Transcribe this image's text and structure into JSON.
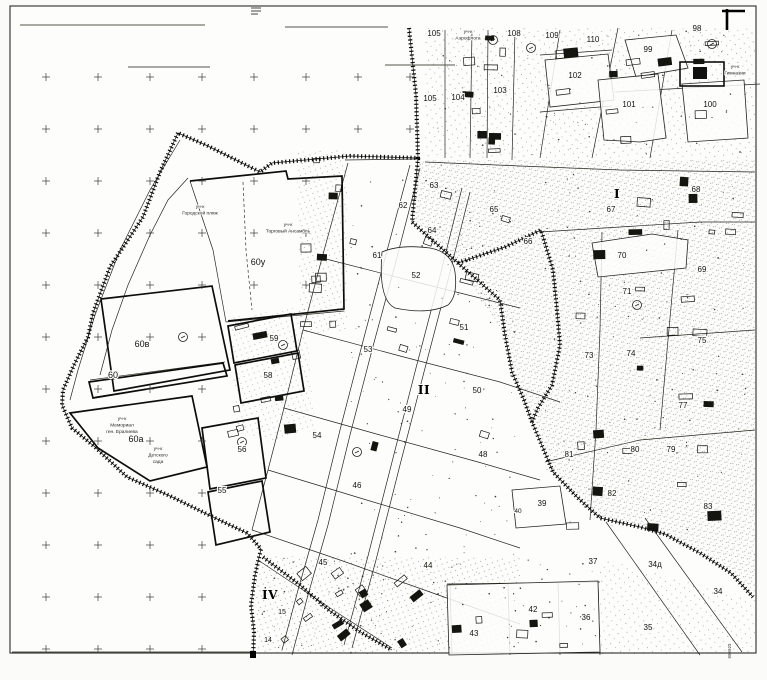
{
  "map": {
    "parcel_labels": [
      {
        "text": "105",
        "x": 434,
        "y": 36
      },
      {
        "text": "108",
        "x": 514,
        "y": 36
      },
      {
        "text": "109",
        "x": 552,
        "y": 38
      },
      {
        "text": "110",
        "x": 593,
        "y": 42
      },
      {
        "text": "98",
        "x": 697,
        "y": 31
      },
      {
        "text": "99",
        "x": 648,
        "y": 52
      },
      {
        "text": "102",
        "x": 575,
        "y": 78
      },
      {
        "text": "101",
        "x": 629,
        "y": 107
      },
      {
        "text": "100",
        "x": 710,
        "y": 107
      },
      {
        "text": "104",
        "x": 458,
        "y": 100
      },
      {
        "text": "103",
        "x": 500,
        "y": 93
      },
      {
        "text": "105",
        "x": 430,
        "y": 101
      },
      {
        "text": "63",
        "x": 434,
        "y": 188
      },
      {
        "text": "62",
        "x": 403,
        "y": 208
      },
      {
        "text": "65",
        "x": 494,
        "y": 212
      },
      {
        "text": "64",
        "x": 432,
        "y": 233
      },
      {
        "text": "66",
        "x": 528,
        "y": 244
      },
      {
        "text": "61",
        "x": 377,
        "y": 258
      },
      {
        "text": "52",
        "x": 416,
        "y": 278
      },
      {
        "text": "51",
        "x": 464,
        "y": 330
      },
      {
        "text": "53",
        "x": 368,
        "y": 352
      },
      {
        "text": "50",
        "x": 477,
        "y": 393
      },
      {
        "text": "49",
        "x": 407,
        "y": 412
      },
      {
        "text": "67",
        "x": 611,
        "y": 212
      },
      {
        "text": "68",
        "x": 696,
        "y": 192
      },
      {
        "text": "70",
        "x": 622,
        "y": 258
      },
      {
        "text": "69",
        "x": 702,
        "y": 272
      },
      {
        "text": "71",
        "x": 627,
        "y": 294
      },
      {
        "text": "73",
        "x": 589,
        "y": 358
      },
      {
        "text": "74",
        "x": 631,
        "y": 356
      },
      {
        "text": "75",
        "x": 702,
        "y": 343
      },
      {
        "text": "77",
        "x": 683,
        "y": 408
      },
      {
        "text": "80",
        "x": 635,
        "y": 452
      },
      {
        "text": "81",
        "x": 569,
        "y": 457
      },
      {
        "text": "79",
        "x": 671,
        "y": 452
      },
      {
        "text": "82",
        "x": 612,
        "y": 496
      },
      {
        "text": "83",
        "x": 708,
        "y": 509
      },
      {
        "text": "39",
        "x": 542,
        "y": 506
      },
      {
        "text": "40",
        "x": 518,
        "y": 513,
        "fs": 6.5
      },
      {
        "text": "37",
        "x": 593,
        "y": 564
      },
      {
        "text": "34д",
        "x": 655,
        "y": 567
      },
      {
        "text": "34",
        "x": 718,
        "y": 594
      },
      {
        "text": "35",
        "x": 648,
        "y": 630
      },
      {
        "text": "36",
        "x": 586,
        "y": 620
      },
      {
        "text": "42",
        "x": 533,
        "y": 612
      },
      {
        "text": "43",
        "x": 474,
        "y": 636
      },
      {
        "text": "44",
        "x": 428,
        "y": 568
      },
      {
        "text": "45",
        "x": 323,
        "y": 565
      },
      {
        "text": "46",
        "x": 357,
        "y": 488
      },
      {
        "text": "48",
        "x": 483,
        "y": 457
      },
      {
        "text": "54",
        "x": 317,
        "y": 438
      },
      {
        "text": "56",
        "x": 242,
        "y": 452
      },
      {
        "text": "55",
        "x": 222,
        "y": 493
      },
      {
        "text": "58",
        "x": 268,
        "y": 378
      },
      {
        "text": "59",
        "x": 274,
        "y": 341
      },
      {
        "text": "15",
        "x": 282,
        "y": 614,
        "fs": 7
      },
      {
        "text": "14",
        "x": 268,
        "y": 642,
        "fs": 7
      }
    ],
    "block_labels": [
      {
        "text": "60у",
        "x": 258,
        "y": 265
      },
      {
        "text": "60в",
        "x": 142,
        "y": 347
      },
      {
        "text": "60",
        "x": 113,
        "y": 378
      },
      {
        "text": "60а",
        "x": 136,
        "y": 442
      }
    ],
    "district_labels": [
      {
        "text": "I",
        "x": 617,
        "y": 198
      },
      {
        "text": "II",
        "x": 424,
        "y": 394
      },
      {
        "text": "IV",
        "x": 270,
        "y": 599
      }
    ],
    "annotations": [
      {
        "lines": [
          "уч-к",
          "Городской пляж"
        ],
        "x": 200,
        "y": 208
      },
      {
        "lines": [
          "уч-к",
          "Торговый Ансамбль"
        ],
        "x": 288,
        "y": 226
      },
      {
        "lines": [
          "уч-к",
          "Мемориал",
          "ген. Ералиева"
        ],
        "x": 122,
        "y": 420
      },
      {
        "lines": [
          "уч-к",
          "Детского",
          "сада"
        ],
        "x": 158,
        "y": 450
      },
      {
        "lines": [
          "уч-к",
          "Гимназии"
        ],
        "x": 735,
        "y": 68
      },
      {
        "lines": [
          "уч-к",
          "Аэрофлота"
        ],
        "x": 468,
        "y": 33
      }
    ],
    "edge_stamp": {
      "text": "000023",
      "x": 731,
      "y": 651
    }
  }
}
